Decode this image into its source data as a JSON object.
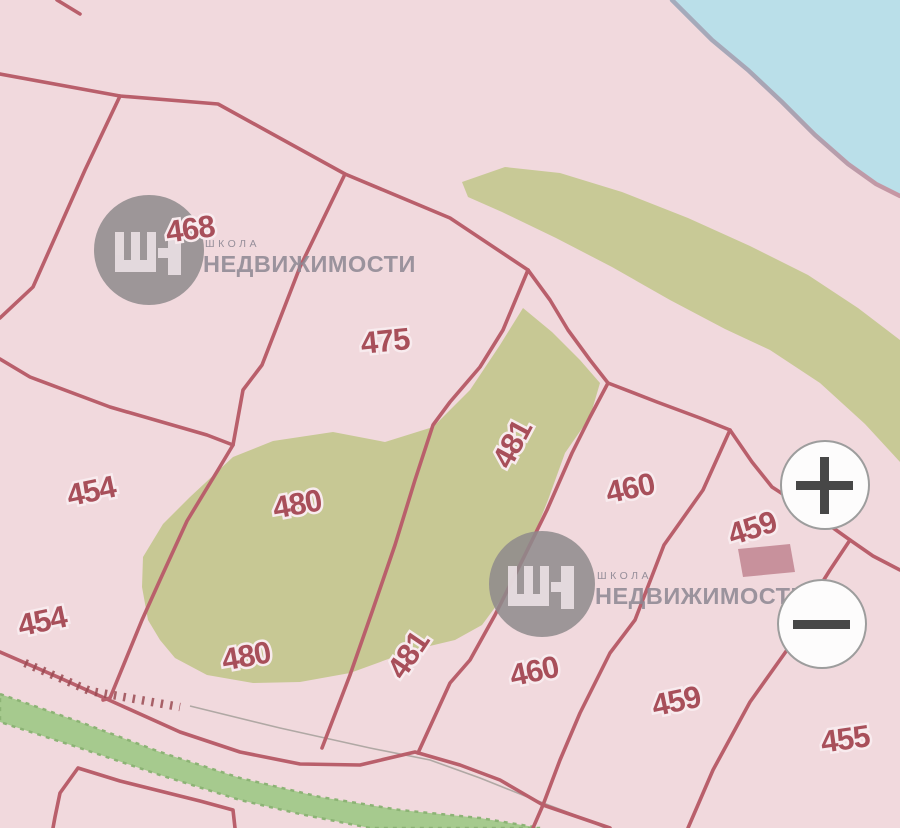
{
  "map": {
    "parcel_labels": [
      {
        "value": "468"
      },
      {
        "value": "475"
      },
      {
        "value": "454"
      },
      {
        "value": "454"
      },
      {
        "value": "480"
      },
      {
        "value": "480"
      },
      {
        "value": "481"
      },
      {
        "value": "481"
      },
      {
        "value": "460"
      },
      {
        "value": "460"
      },
      {
        "value": "459"
      },
      {
        "value": "459"
      },
      {
        "value": "455"
      }
    ],
    "colors": {
      "water": "#badfe9",
      "land": "#f1d9dd",
      "vegetation": "#c7c894",
      "roadside_green": "#a6ca8e",
      "parcel_line": "#b95f6b",
      "parcel_label": "#a84f5a",
      "building": "#c8919c",
      "watermark_gray": "#8d888b"
    }
  },
  "watermark": {
    "line1": "ШКОЛА",
    "line2": "НЕДВИЖИМОСТИ"
  },
  "controls": {
    "zoom_in_label": "+",
    "zoom_out_label": "−"
  }
}
